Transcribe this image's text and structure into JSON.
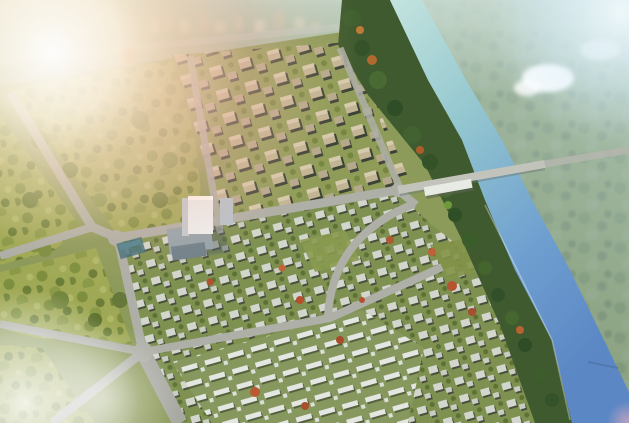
{
  "scene": {
    "kind": "aerial-architectural-rendering",
    "description": "Bird's-eye rendering of a planned riverside residential community: a grid of mid-rise apartment blocks to the north, low-rise villa clusters inside a curving loop road, white townhouse rows to the south, landscaped park blocks to the west, a central white office tower, and a blue river crossed by a bridge running to the bottom-right corner; strong sun flare washes out the upper-left corner",
    "regions": {
      "sun_flare": {
        "label": "Bright sun flare glow washing out the upper-left corner",
        "color": "#fdf5e6"
      },
      "horizon_buildings": {
        "label": "Hazy distant low buildings along the top horizon",
        "color": "#d9c8a9"
      },
      "north_boundary_road": {
        "label": "Hazy northern boundary road along the horizon",
        "color": "#b2b3aa"
      },
      "far_bank": {
        "label": "Hazy farmland and tree masses beyond the river",
        "color": "#7a8f63"
      },
      "sky_glow_top_right": {
        "label": "Pale blue-white glow in the top-right corner",
        "color": "#eefaff"
      },
      "cloud": {
        "label": "Small white cloud puff over the far bank",
        "color": "#ffffff"
      },
      "river": {
        "label": "River flowing from top center to the bottom-right corner, pale cyan upstream and deep blue downstream",
        "color_upstream": "#bfe2de",
        "color_downstream": "#5b87c4"
      },
      "bridge": {
        "label": "Gray road bridge crossing the river at mid-height",
        "color": "#c2c3ba"
      },
      "riverside_tree_belt": {
        "label": "Dense dark-green tree belt with orange accents along the near riverbank",
        "color": "#3f5a2e"
      },
      "central_park": {
        "label": "Olive-green landscaped park blocks with tree clusters on the west side",
        "color": "#9fa955"
      },
      "apartment_district": {
        "label": "Diagonal grid of tan mid-rise apartment blocks in the upper middle",
        "color": "#c2b595"
      },
      "villa_district": {
        "label": "Low-rise gray-white villa clusters between the loop road and the river",
        "color": "#d3d6cd"
      },
      "townhouse_district": {
        "label": "Rows of bright white townhouses at the bottom center",
        "color": "#e4e7e1"
      },
      "office_tower": {
        "label": "White high-rise tower with bluish podium near the site center",
        "color": "#eef1f2"
      },
      "commercial_slab": {
        "label": "Long low white commercial building beside the bridge road",
        "color": "#e8eae4"
      },
      "sports_courts": {
        "label": "Small blue-green sports courts strip near the tower",
        "color": "#3f6f7a"
      },
      "road_network": {
        "label": "Gray arterial roads: western spine, east-west bridge road, southern crossroads and curving villa loop",
        "color": "#aeafa7"
      },
      "autumn_trees": {
        "label": "Scattered orange-red autumn accent trees",
        "color": "#b0622e"
      },
      "bottom_left_haze": {
        "label": "White cloud haze over the bottom-left corner",
        "color": "#ffffff"
      },
      "bottom_right_smudge": {
        "label": "Tiny pink glare smudge in the bottom-right corner",
        "color": "#f0b0c0"
      }
    }
  }
}
